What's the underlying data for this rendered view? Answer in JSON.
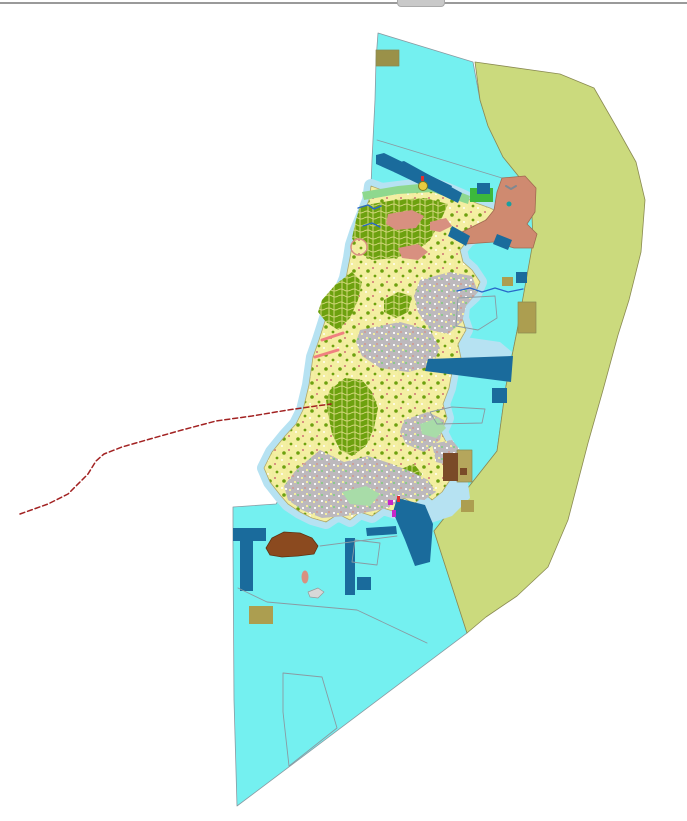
{
  "meta": {
    "width": 687,
    "height": 821,
    "background": "#ffffff"
  },
  "chrome": {
    "top_border_color": "#9a9a9a",
    "scroll_remnant_color": "#c9c9c9"
  },
  "palette": {
    "sea": "#74f0f0",
    "shore": "#b6e2f2",
    "buffer": "#cbda7d",
    "bufferEdge": "#8a8a52",
    "island": "#f4efa2",
    "islandEdge": "#b0a86a",
    "forest": "#6da10f",
    "forestVein": "#e9e492",
    "urban": "#bdb9bd",
    "urbanSpeck1": "#ffffff",
    "urbanSpeck2": "#f2eda0",
    "urbanSpeck3": "#8cc88c",
    "salmon": "#cf8a70",
    "salmonEdge": "#a06a50",
    "salmonPatch": "#d89080",
    "navy": "#1a6b9c",
    "khaki": "#ac9e50",
    "khakiDark": "#9a9149",
    "tan": "#b5a65c",
    "brown": "#7a4a28",
    "brownBlob": "#8b4a1f",
    "brownBlobEdge": "#5f3210",
    "coastGreen": "#8ed88e",
    "parkGreen": "#3cb83c",
    "paleGreen": "#a8dca8",
    "grayLine": "#8a9aa2",
    "redDash": "#a22222",
    "pinkStroke": "#f08080",
    "magenta": "#c826c8",
    "red": "#e03030",
    "stream": "#2868c8",
    "islet": "#d8d8d8",
    "isletEdge": "#999999",
    "teal": "#18a0a0",
    "markerYellow": "#e8cc40",
    "markerEdge": "#7a7a20",
    "anchorGray": "#808890"
  },
  "map": {
    "layers": [
      {
        "name": "marine-zone",
        "kind": "polygon",
        "pts": "378,33 473,62 480,100 488,126 503,157 520,178 531,190 536,242 517,331 506,386 497,451 434,531 467,633 237,806 234,700 233,545 233,507 276,504 281,496 270,482 264,468 272,452 285,436 296,424 303,410 309,385 313,357 319,340 326,318 337,300 346,278 350,258 352,245 357,230 364,213 369,200 371,186 372,160 375,100 376,60",
        "fill": "sea",
        "stroke": "grayLine",
        "sw": 0.8
      },
      {
        "name": "buffer-zone",
        "kind": "polygon",
        "pts": "475,62 560,74 594,88 617,128 636,162 645,200 641,252 629,300 618,335 603,390 588,443 568,520 548,567 517,596 486,617 467,633 434,531 497,451 506,386 517,331 533,242 531,190 520,178 503,157 488,126 480,100",
        "fill": "buffer",
        "stroke": "bufferEdge",
        "sw": 0.8
      },
      {
        "name": "boundary-line-northeast",
        "kind": "line",
        "x1": 377,
        "y1": 140,
        "x2": 502,
        "y2": 178,
        "stroke": "grayLine",
        "sw": 0.8
      },
      {
        "name": "nearshore-halo",
        "kind": "polygon",
        "pts": "371,186 382,190 398,188 415,186 432,184 448,190 462,196 476,203 490,208 500,213 504,220 495,228 480,234 468,240 460,250 463,262 472,270 480,282 474,296 463,306 462,318 466,330 458,344 461,358 452,372 449,388 443,404 447,418 441,432 448,446 452,458 445,468 450,480 442,492 432,500 425,494 414,504 404,498 396,512 383,508 372,516 360,512 350,520 338,514 326,522 312,518 300,512 288,504 281,496 270,482 264,468 272,452 285,436 296,424 303,410 309,385 313,357 319,340 326,318 337,300 346,278 350,258 352,245 357,230 364,213 369,200",
        "fill": "none",
        "stroke": "shore",
        "sw": 14
      },
      {
        "name": "nearshore-bay-southeast",
        "kind": "polygon",
        "pts": "414,470 444,462 466,468 470,498 452,516 428,524 410,508 406,488",
        "fill": "shore"
      },
      {
        "name": "nearshore-bay-northeast",
        "kind": "polygon",
        "pts": "444,334 500,342 512,352 510,357 430,360 438,344",
        "fill": "shore"
      },
      {
        "name": "island-landmass",
        "kind": "polygon",
        "pts": "371,186 382,190 398,188 415,186 432,184 448,190 462,196 476,203 490,208 500,213 504,220 495,228 480,234 468,240 460,250 463,262 472,270 480,282 474,296 463,306 462,318 466,330 458,344 461,358 452,372 449,388 443,404 447,418 441,432 448,446 452,458 445,468 450,480 442,492 432,500 425,494 414,504 404,498 396,512 383,508 372,516 360,512 350,520 338,514 326,522 312,518 300,512 288,504 281,496 270,482 264,468 272,452 285,436 296,424 303,410 309,385 313,357 319,340 326,318 337,300 346,278 350,258 352,245 357,230 364,213 369,200",
        "fill": "@pat:island",
        "stroke": "islandEdge",
        "sw": 0.8
      },
      {
        "name": "coastal-green-strip-north",
        "kind": "polygon",
        "pts": "362,192 398,186 430,183 452,189 470,196 468,204 432,192 398,194 364,200",
        "fill": "coastGreen"
      },
      {
        "name": "forest-zone-north",
        "kind": "polygon",
        "pts": "360,206 395,200 425,198 448,204 440,222 430,240 415,252 395,258 372,260 358,252 352,238 356,220",
        "fill": "@pat:forest"
      },
      {
        "name": "forest-zone-west",
        "kind": "polygon",
        "pts": "322,300 336,284 352,272 362,282 358,300 350,318 338,330 326,322 318,312",
        "fill": "@pat:forest"
      },
      {
        "name": "forest-zone-central",
        "kind": "polygon",
        "pts": "330,390 345,378 362,380 372,392 378,408 374,428 366,446 352,456 340,450 332,434 328,414 326,400",
        "fill": "@pat:forest"
      },
      {
        "name": "forest-zone-east",
        "kind": "polygon",
        "pts": "384,300 398,292 412,296 408,312 396,318 384,312",
        "fill": "@pat:forest"
      },
      {
        "name": "forest-zone-south",
        "kind": "polygon",
        "pts": "398,470 414,464 422,474 414,486 400,482",
        "fill": "@pat:forest"
      },
      {
        "name": "urban-zone-east-central",
        "kind": "polygon",
        "pts": "420,280 450,272 472,276 478,292 466,306 462,322 448,334 430,330 418,312 414,296",
        "fill": "@pat:urban"
      },
      {
        "name": "urban-zone-mid",
        "kind": "polygon",
        "pts": "360,330 400,322 430,330 440,348 432,366 408,372 380,368 362,356 356,342",
        "fill": "@pat:urban"
      },
      {
        "name": "urban-zone-south",
        "kind": "polygon",
        "pts": "296,470 320,450 344,462 368,456 392,464 412,472 428,480 436,492 424,500 404,498 388,508 368,512 346,516 322,518 302,510 288,500 284,486",
        "fill": "@pat:urban"
      },
      {
        "name": "urban-zone-southeast",
        "kind": "polygon",
        "pts": "404,420 428,412 444,420 440,440 424,452 406,444 400,432",
        "fill": "@pat:urban"
      },
      {
        "name": "urban-zone-east",
        "kind": "polygon",
        "pts": "432,444 452,440 462,452 452,466 436,462",
        "fill": "@pat:urban"
      },
      {
        "name": "settlement-patch-1",
        "kind": "polygon",
        "pts": "388,214 412,210 424,216 416,228 396,230 386,224",
        "fill": "salmonPatch"
      },
      {
        "name": "settlement-patch-2",
        "kind": "polygon",
        "pts": "398,248 418,244 428,252 418,260 402,258",
        "fill": "salmonPatch"
      },
      {
        "name": "settlement-patch-3",
        "kind": "polygon",
        "pts": "430,222 446,218 452,226 440,232 430,230",
        "fill": "salmonPatch"
      },
      {
        "name": "park-patch-south",
        "kind": "polygon",
        "pts": "342,492 366,486 380,494 370,506 350,504",
        "fill": "paleGreen"
      },
      {
        "name": "park-patch-mid",
        "kind": "polygon",
        "pts": "420,424 438,418 446,428 436,438 422,434",
        "fill": "paleGreen"
      },
      {
        "name": "headland-zone-northeast",
        "kind": "polygon",
        "pts": "502,178 525,176 536,188 535,212 527,224 537,234 533,248 514,248 494,242 466,244 458,234 472,227 486,220 494,210 497,192",
        "fill": "salmon",
        "stroke": "salmonEdge",
        "sw": 0.8
      },
      {
        "name": "islet-ring-west",
        "kind": "circle",
        "cx": 359,
        "cy": 247,
        "r": 8,
        "fill": "@pat:island",
        "stroke": "salmonPatch",
        "sw": 1.5
      },
      {
        "name": "park-rect-northeast",
        "kind": "rect",
        "x": 470,
        "y": 188,
        "w": 23,
        "h": 14,
        "fill": "parkGreen"
      },
      {
        "name": "port-breakwater-north-1",
        "kind": "polygon",
        "pts": "376,155 384,153 452,186 448,196 376,164",
        "fill": "navy"
      },
      {
        "name": "port-breakwater-north-2",
        "kind": "polygon",
        "pts": "396,163 404,161 462,193 458,203 394,172",
        "fill": "navy"
      },
      {
        "name": "port-quay-northeast",
        "kind": "rect",
        "x": 477,
        "y": 183,
        "w": 13,
        "h": 11,
        "fill": "navy"
      },
      {
        "name": "port-structure-east-1",
        "kind": "polygon",
        "pts": "452,226 470,236 466,246 448,236",
        "fill": "navy"
      },
      {
        "name": "port-structure-east-2",
        "kind": "polygon",
        "pts": "497,234 512,240 508,250 493,244",
        "fill": "navy"
      },
      {
        "name": "anchorage-zone-east",
        "kind": "polygon",
        "pts": "428,359 513,356 511,382 425,371",
        "fill": "navy"
      },
      {
        "name": "anchorage-square-east",
        "kind": "rect",
        "x": 492,
        "y": 388,
        "w": 15,
        "h": 15,
        "fill": "navy"
      },
      {
        "name": "harbor-basin-south",
        "kind": "polygon",
        "pts": "397,498 425,505 433,524 430,562 415,566 405,540 393,512",
        "fill": "navy"
      },
      {
        "name": "pier-bar-south",
        "kind": "polygon",
        "pts": "366,528 396,526 397,534 367,536",
        "fill": "navy"
      },
      {
        "name": "pier-strip-south",
        "kind": "rect",
        "x": 345,
        "y": 538,
        "w": 10,
        "h": 57,
        "fill": "navy"
      },
      {
        "name": "mooring-square-south",
        "kind": "rect",
        "x": 357,
        "y": 577,
        "w": 14,
        "h": 13,
        "fill": "navy"
      },
      {
        "name": "t-pier-west-bar",
        "kind": "rect",
        "x": 233,
        "y": 528,
        "w": 33,
        "h": 13,
        "fill": "navy"
      },
      {
        "name": "t-pier-west-stem",
        "kind": "rect",
        "x": 240,
        "y": 541,
        "w": 13,
        "h": 50,
        "fill": "navy"
      },
      {
        "name": "mooring-square-northeast",
        "kind": "rect",
        "x": 516,
        "y": 272,
        "w": 11,
        "h": 11,
        "fill": "navy"
      },
      {
        "name": "khaki-parcel-top",
        "kind": "rect",
        "x": 376,
        "y": 50,
        "w": 23,
        "h": 16,
        "fill": "khakiDark",
        "stroke": "bufferEdge",
        "sw": 0.7
      },
      {
        "name": "khaki-square-northeast",
        "kind": "rect",
        "x": 502,
        "y": 277,
        "w": 11,
        "h": 9,
        "fill": "khaki"
      },
      {
        "name": "khaki-parcel-east",
        "kind": "rect",
        "x": 518,
        "y": 302,
        "w": 18,
        "h": 31,
        "fill": "khaki",
        "stroke": "bufferEdge",
        "sw": 0.7
      },
      {
        "name": "khaki-parcel-south",
        "kind": "rect",
        "x": 249,
        "y": 606,
        "w": 24,
        "h": 18,
        "fill": "khaki"
      },
      {
        "name": "khaki-square-bay",
        "kind": "rect",
        "x": 461,
        "y": 500,
        "w": 13,
        "h": 12,
        "fill": "khaki"
      },
      {
        "name": "tan-parcel-east",
        "kind": "rect",
        "x": 457,
        "y": 450,
        "w": 15,
        "h": 32,
        "fill": "tan",
        "stroke": "bufferEdge",
        "sw": 0.7
      },
      {
        "name": "tan-parcel-inner-mark",
        "kind": "rect",
        "x": 460,
        "y": 468,
        "w": 7,
        "h": 7,
        "fill": "brown"
      },
      {
        "name": "brown-parcel-east",
        "kind": "rect",
        "x": 443,
        "y": 453,
        "w": 15,
        "h": 28,
        "fill": "brown"
      },
      {
        "name": "reclamation-area-south",
        "kind": "polygon",
        "pts": "266,548 272,538 284,532 300,533 312,538 318,546 314,554 298,556 282,557 270,555",
        "fill": "brownBlob",
        "stroke": "brownBlobEdge",
        "sw": 0.8
      },
      {
        "name": "islet-salmon-south",
        "kind": "ellipse",
        "cx": 305,
        "cy": 577,
        "rx": 3.5,
        "ry": 6.5,
        "fill": "salmonPatch"
      },
      {
        "name": "islet-gray-south",
        "kind": "polygon",
        "pts": "308,592 318,588 324,592 318,598 310,597",
        "fill": "islet",
        "stroke": "isletEdge",
        "sw": 0.7
      },
      {
        "name": "parcel-outline-south-line",
        "kind": "polyline",
        "pts": "238,588 267,602 357,610 427,643",
        "stroke": "grayLine",
        "sw": 0.9
      },
      {
        "name": "parcel-outline-coast-line",
        "kind": "polyline",
        "pts": "320,546 397,536",
        "stroke": "grayLine",
        "sw": 0.9
      },
      {
        "name": "parcel-outline-bottom",
        "kind": "polygon",
        "pts": "283,673 322,677 337,728 289,766 283,712",
        "fill": "none",
        "stroke": "grayLine",
        "sw": 0.9
      },
      {
        "name": "parcel-outline-harbor",
        "kind": "polygon",
        "pts": "355,540 380,543 377,565 352,562",
        "fill": "none",
        "stroke": "grayLine",
        "sw": 0.9
      },
      {
        "name": "parcel-outline-east-bay",
        "kind": "polygon",
        "pts": "430,412 452,407 485,409 482,423 437,424",
        "fill": "none",
        "stroke": "grayLine",
        "sw": 0.9
      },
      {
        "name": "parcel-outline-east-mid",
        "kind": "polygon",
        "pts": "458,298 495,296 497,318 478,330 456,326",
        "fill": "none",
        "stroke": "grayLine",
        "sw": 0.9
      },
      {
        "name": "stream-northwest-1",
        "kind": "polyline",
        "pts": "358,208 368,205 374,209 381,206",
        "stroke": "stream",
        "sw": 1.4
      },
      {
        "name": "stream-northwest-2",
        "kind": "polyline",
        "pts": "363,226 372,223 380,227",
        "stroke": "stream",
        "sw": 1.4
      },
      {
        "name": "stream-east",
        "kind": "polyline",
        "pts": "457,291 470,288 482,292 495,288 508,292 523,289",
        "stroke": "stream",
        "sw": 1.2
      },
      {
        "name": "pink-mark-west-1",
        "kind": "line",
        "x1": 322,
        "y1": 340,
        "x2": 343,
        "y2": 333,
        "stroke": "pinkStroke",
        "sw": 3
      },
      {
        "name": "pink-mark-west-2",
        "kind": "line",
        "x1": 315,
        "y1": 357,
        "x2": 338,
        "y2": 350,
        "stroke": "pinkStroke",
        "sw": 3
      },
      {
        "name": "magenta-mark-1",
        "kind": "rect",
        "x": 388,
        "y": 500,
        "w": 5,
        "h": 5,
        "fill": "magenta"
      },
      {
        "name": "magenta-mark-2",
        "kind": "rect",
        "x": 392,
        "y": 510,
        "w": 4,
        "h": 7,
        "fill": "magenta"
      },
      {
        "name": "red-mark-harbor",
        "kind": "rect",
        "x": 397,
        "y": 496,
        "w": 3,
        "h": 6,
        "fill": "red"
      },
      {
        "name": "buoy-marker-north",
        "kind": "circle",
        "cx": 423,
        "cy": 186,
        "r": 4.5,
        "fill": "markerYellow",
        "stroke": "markerEdge",
        "sw": 1
      },
      {
        "name": "buoy-marker-tick",
        "kind": "rect",
        "x": 421,
        "y": 176,
        "w": 3,
        "h": 5,
        "fill": "red"
      },
      {
        "name": "anchor-symbol-headland",
        "kind": "polyline",
        "pts": "506,186 511,189 516,186",
        "stroke": "anchorGray",
        "sw": 2
      },
      {
        "name": "teal-dot-headland",
        "kind": "circle",
        "cx": 509,
        "cy": 204,
        "r": 2.5,
        "fill": "teal"
      },
      {
        "name": "municipal-boundary-dashed",
        "kind": "polyline",
        "pts": "20,514 48,504 68,494 88,474 96,461 104,454 122,447 150,439 182,430 216,421 252,416 288,410 316,406 331,404",
        "stroke": "redDash",
        "sw": 1.5,
        "dash": "5 3"
      }
    ]
  }
}
